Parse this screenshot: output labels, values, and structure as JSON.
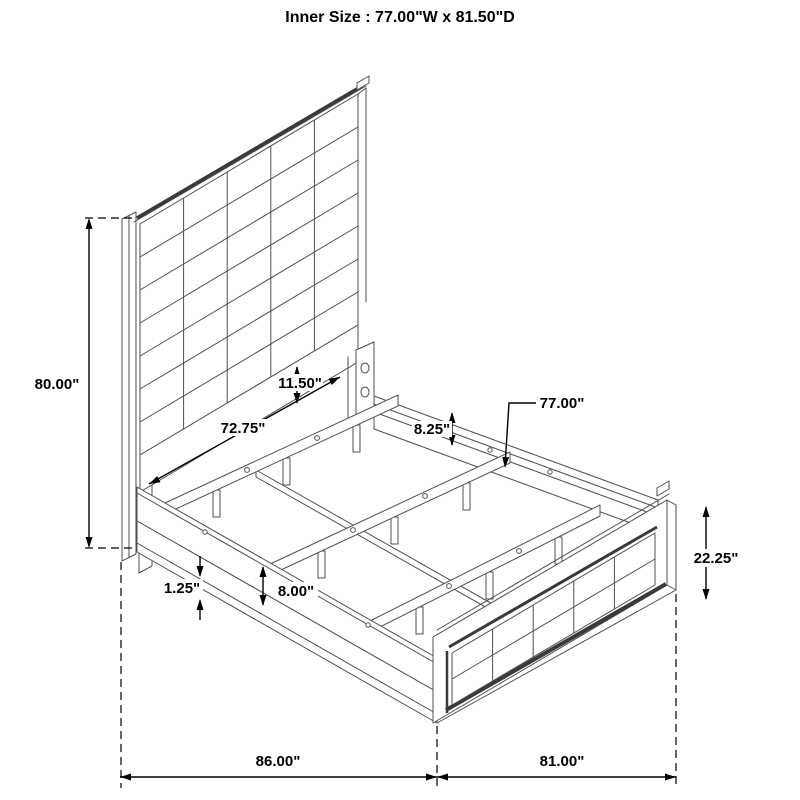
{
  "title": "Inner Size : 77.00\"W x 81.50\"D",
  "diagram": {
    "subject": "bed-frame-assembly-isometric",
    "parts": [
      "headboard",
      "side-rails",
      "slats",
      "support-legs",
      "center-rail",
      "footboard",
      "mounting-bracket"
    ]
  },
  "dimensions": {
    "headboard_height": "80.00\"",
    "lower_panel_height": "11.50\"",
    "headboard_inner_width": "72.75\"",
    "rail_top_to_slat": "8.25\"",
    "slat_length": "77.00\"",
    "slat_leg_height": "8.00\"",
    "rail_lip_thickness": "1.25\"",
    "footboard_height": "22.25\"",
    "overall_length": "86.00\"",
    "overall_width": "81.00\""
  },
  "colors": {
    "background": "#ffffff",
    "drawing_line": "#4f4f4f",
    "dimension_line": "#000000",
    "text": "#000000"
  }
}
